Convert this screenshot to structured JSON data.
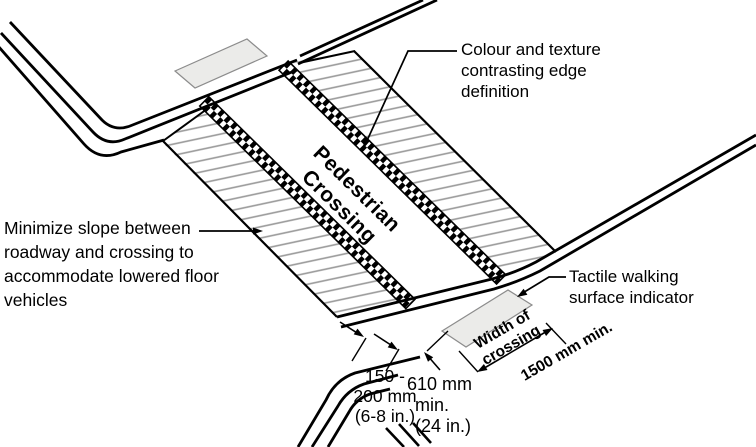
{
  "colors": {
    "line": "#000000",
    "hatch": "#999999",
    "tactile_fill": "#ebebe9"
  },
  "crossing_label": [
    "Pedestrian",
    "Crossing"
  ],
  "annotations": {
    "edge": [
      "Colour and texture",
      "contrasting edge",
      "definition"
    ],
    "slope": [
      "Minimize slope between",
      "roadway and crossing to",
      "accommodate lowered floor",
      "vehicles"
    ],
    "tactile": [
      "Tactile walking",
      "surface indicator"
    ]
  },
  "dimensions": {
    "edge_strip": [
      "150 -",
      "200 mm",
      "(6-8 in.)"
    ],
    "setback": [
      "610 mm",
      "min.",
      "(24 in.)"
    ],
    "crossing_width": [
      "Width of",
      "crossing"
    ],
    "crossing_width_value": "1500 mm min."
  }
}
